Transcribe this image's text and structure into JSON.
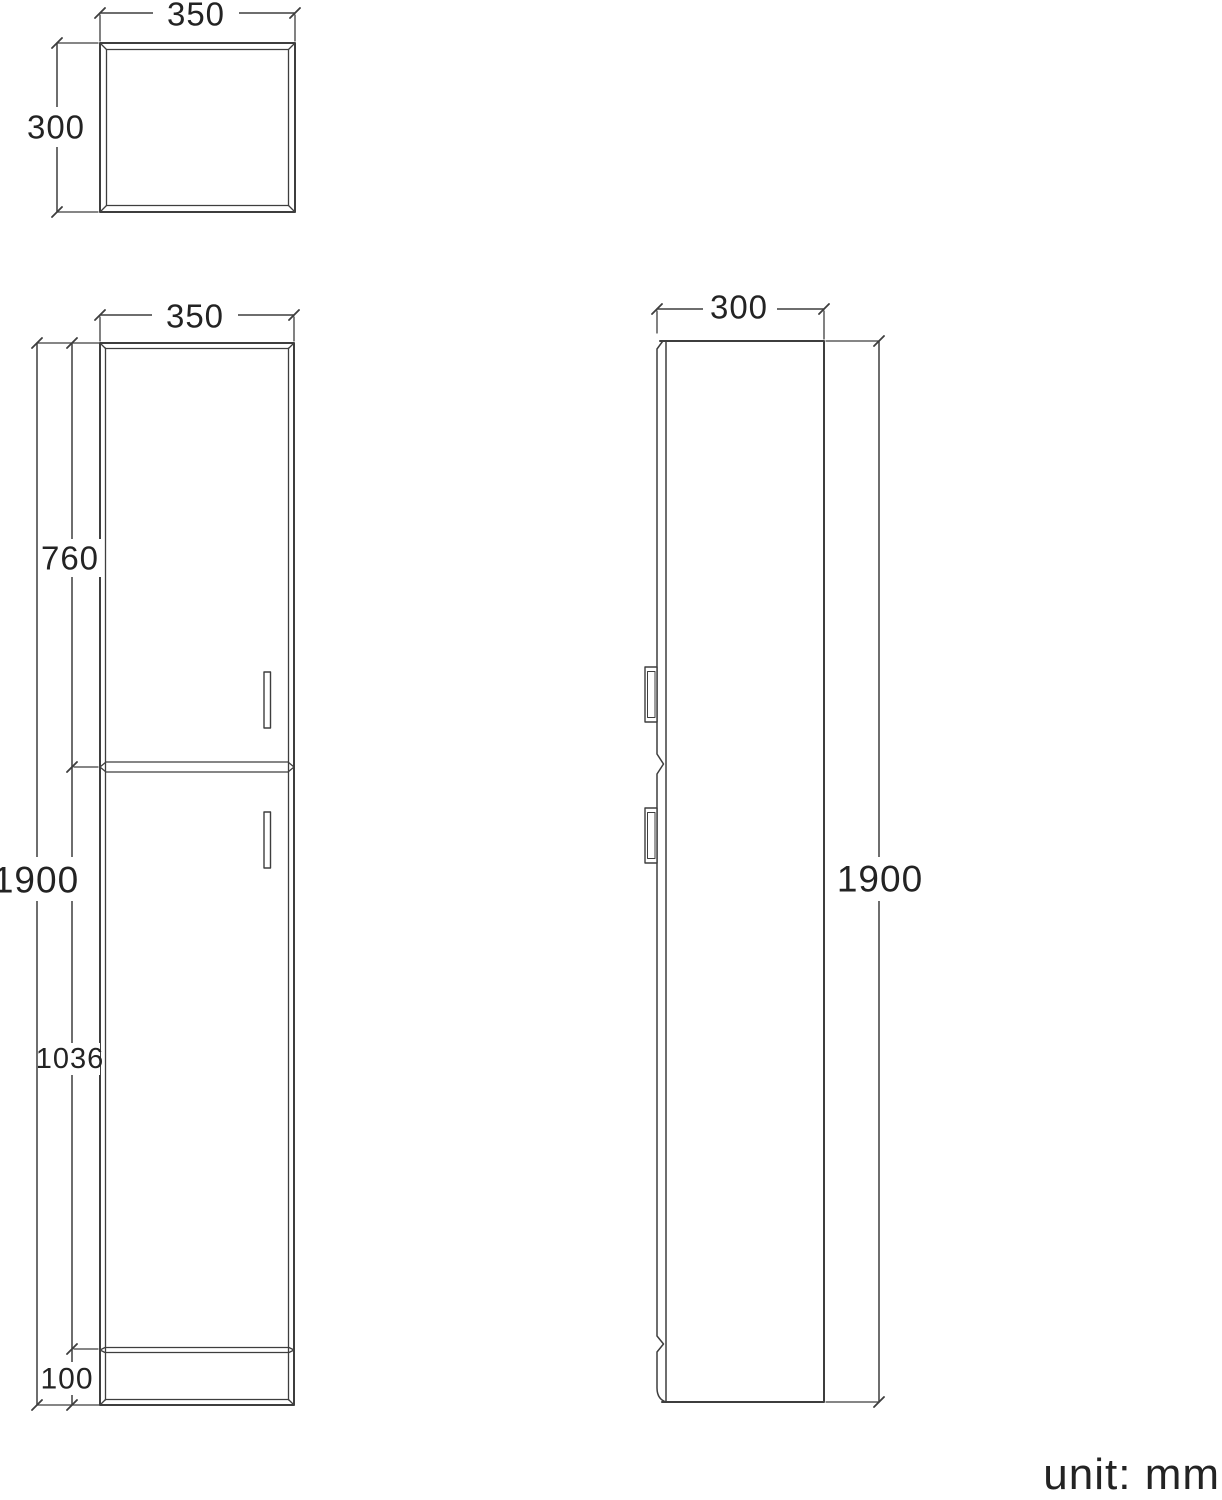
{
  "drawing": {
    "type": "furniture dimension drawing (tall two-door cabinet, three orthographic views)",
    "unit_label": "unit: mm",
    "views": {
      "top": {
        "width": "350",
        "depth": "300"
      },
      "front": {
        "width": "350",
        "overall_height": "1900",
        "upper_door_height": "760",
        "lower_door_height": "1036",
        "plinth_height": "100"
      },
      "side": {
        "depth": "300",
        "overall_height": "1900"
      }
    }
  },
  "colors": {
    "line": "#3e3e3e",
    "text": "#232323",
    "background": "#ffffff"
  }
}
